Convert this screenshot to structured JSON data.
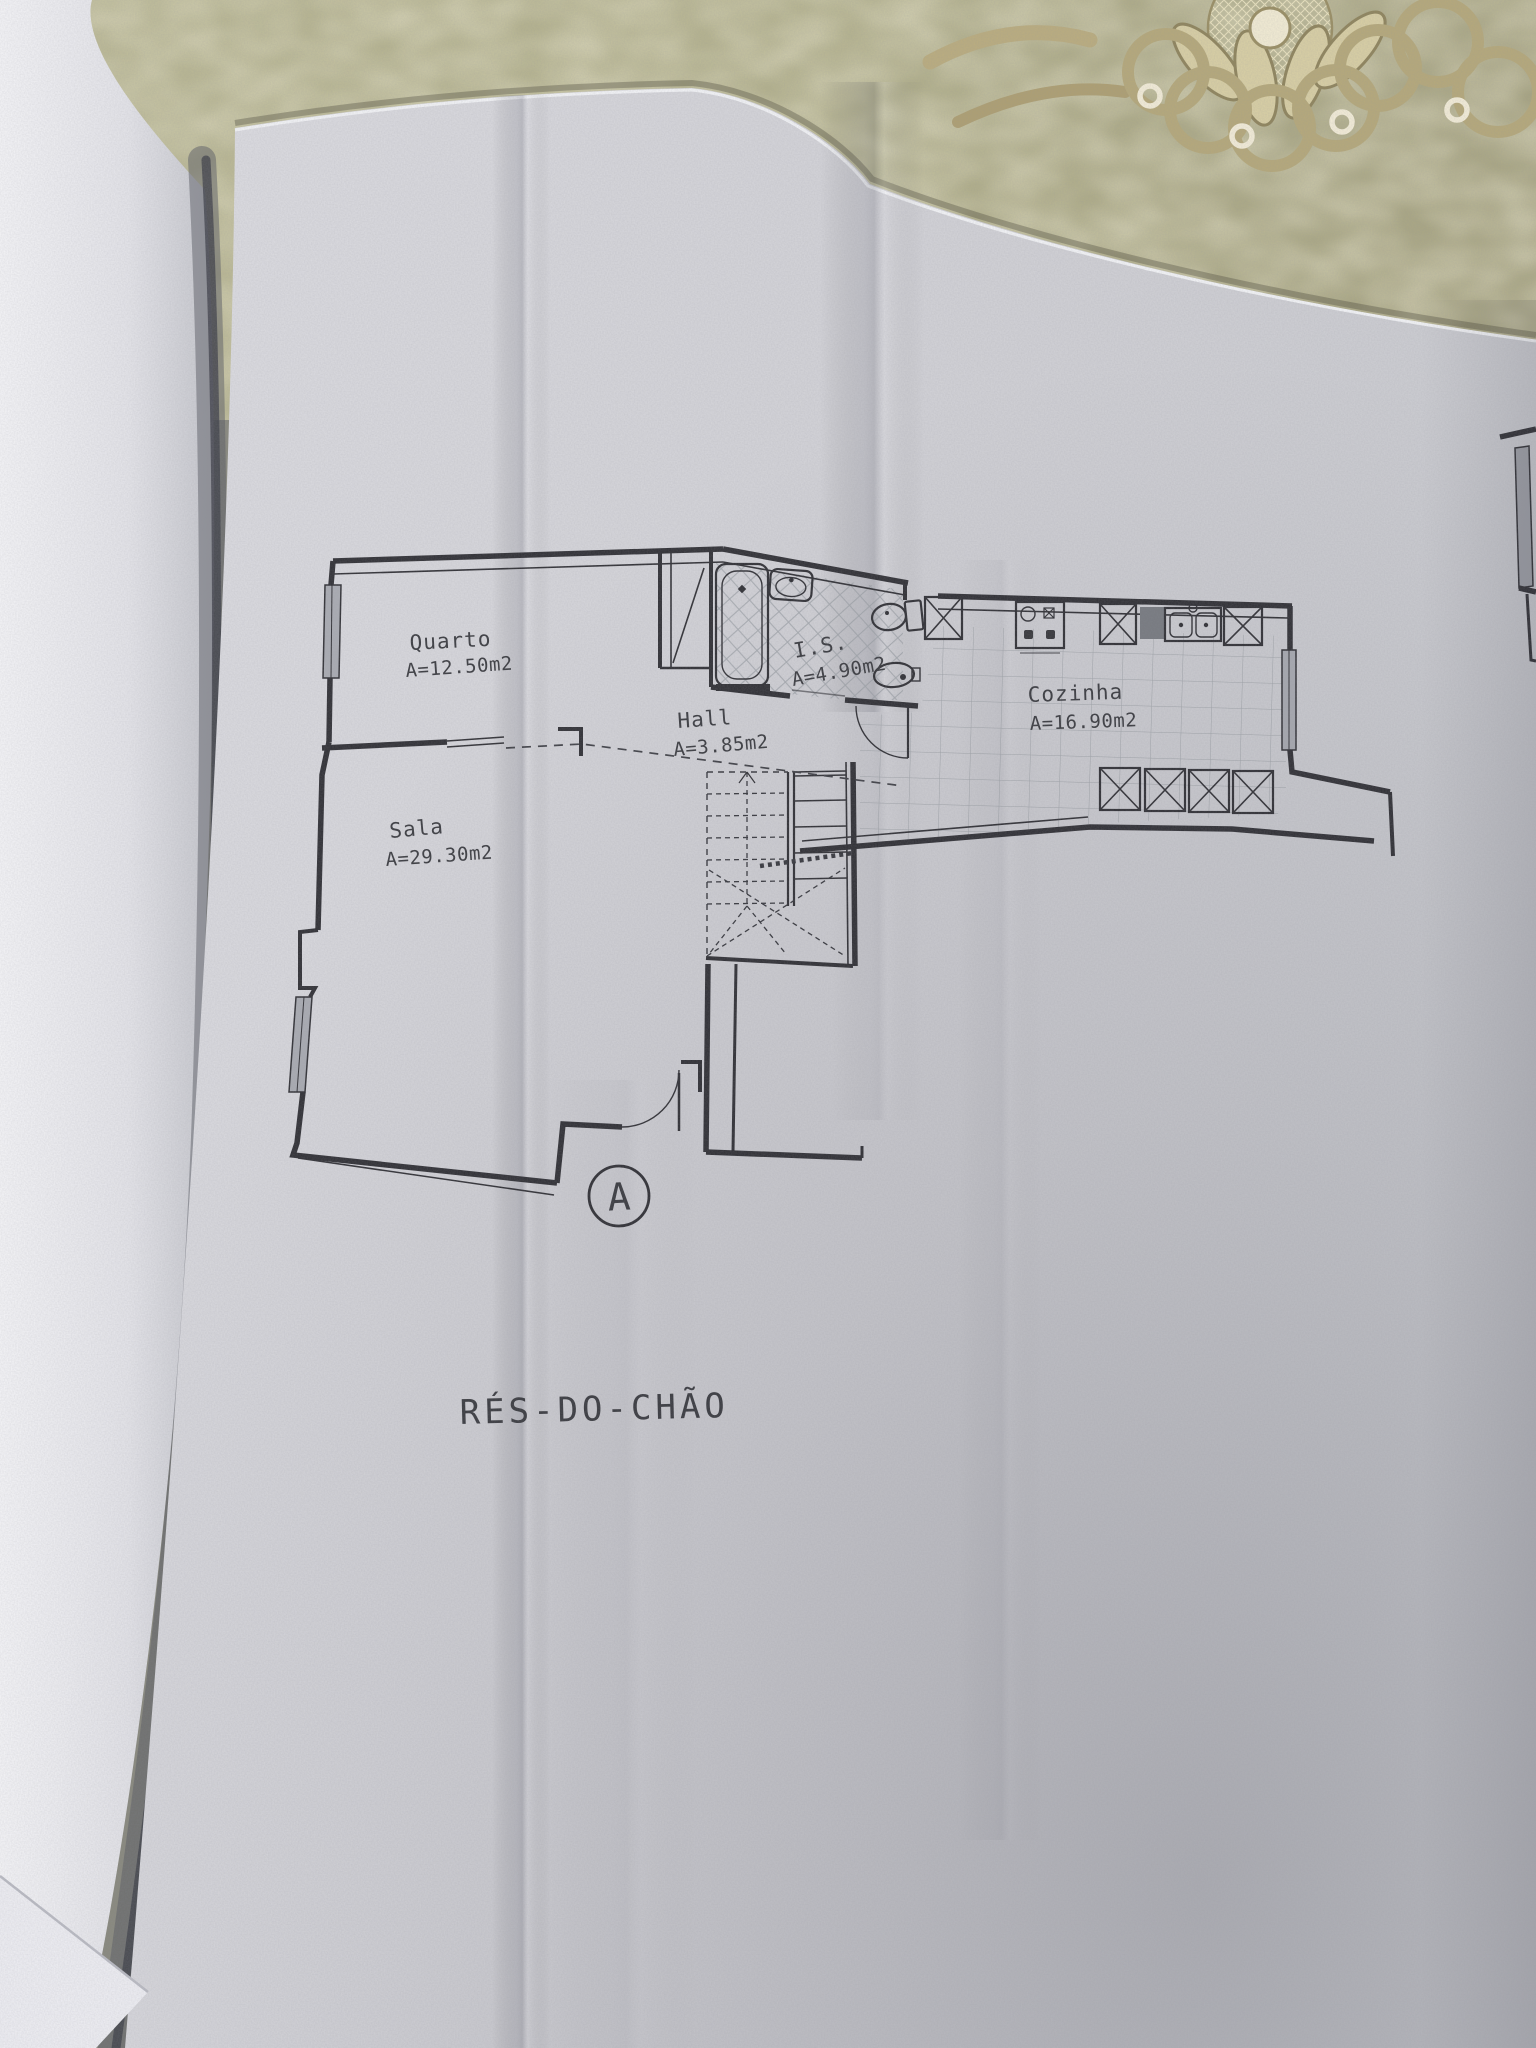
{
  "scene": {
    "description": "Photograph of an architectural ground-floor plan on an open fold-out page lying on a damask tablecloth with a gold lace doily",
    "colors": {
      "tablecloth": "#b2b08d",
      "tablecloth_pattern": "#ddd7ae",
      "doily_gold": "#b9ac80",
      "doily_cream": "#efe8d2",
      "paper": "#d2d3d8",
      "paper_left_page": "#eeeef2",
      "gutter_shadow": "#55565e",
      "ink": "#35353a",
      "text": "#3f4045",
      "window_fill": "#aaacb3",
      "tile_line": "#989da2"
    }
  },
  "plan": {
    "title": "RÉS-DO-CHÃO",
    "section_marker": "A",
    "rooms": [
      {
        "name": "Quarto",
        "area": "A=12.50m2"
      },
      {
        "name": "I.S.",
        "area": "A=4.90m2"
      },
      {
        "name": "Hall",
        "area": "A=3.85m2"
      },
      {
        "name": "Cozinha",
        "area": "A=16.90m2"
      },
      {
        "name": "Sala",
        "area": "A=29.30m2"
      }
    ]
  }
}
